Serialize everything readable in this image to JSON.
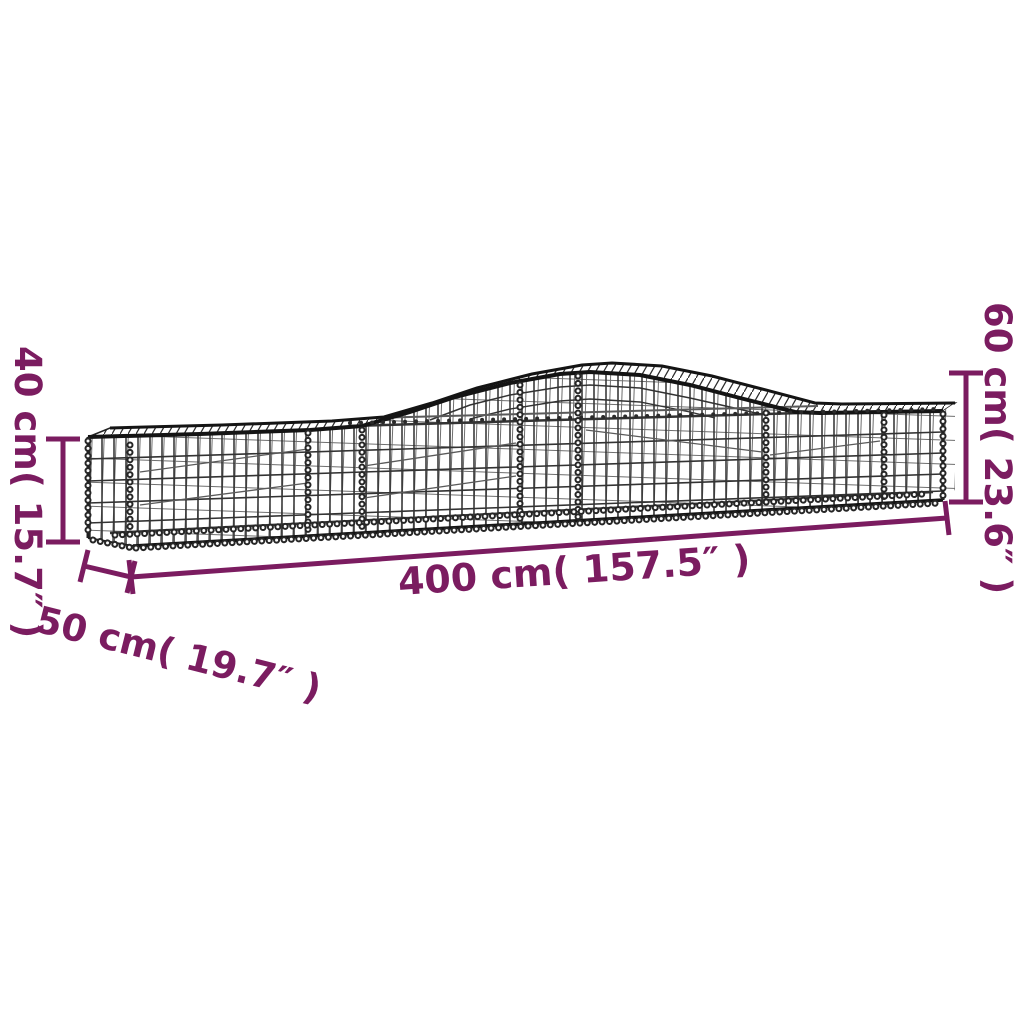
{
  "colors": {
    "accent": "#7B1C60",
    "wire": "#2B2B2B",
    "wire-light": "#5a5a5a",
    "bg": "#ffffff"
  },
  "diagram": {
    "subject": "arched gabion wire mesh basket",
    "labels": {
      "height_left": "40 cm( 15.7″ )",
      "height_right": "60 cm( 23.6″ )",
      "length": "400 cm( 157.5″ )",
      "depth": "50 cm( 19.7″ )"
    }
  }
}
